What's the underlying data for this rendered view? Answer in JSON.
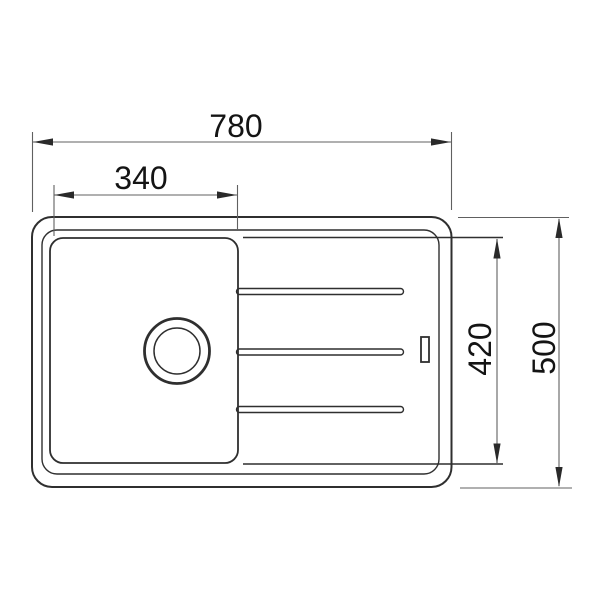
{
  "page": {
    "background": "#ffffff"
  },
  "diagram": {
    "type": "technical-drawing",
    "subject": "sink-top-view-with-drainboard",
    "colors": {
      "outline": "#2f2f2f",
      "dimension_line": "#606060",
      "text": "#141414",
      "background": "#ffffff"
    },
    "dimensions": {
      "overall_width": "780",
      "bowl_width": "340",
      "inner_depth": "420",
      "overall_depth": "500"
    }
  }
}
